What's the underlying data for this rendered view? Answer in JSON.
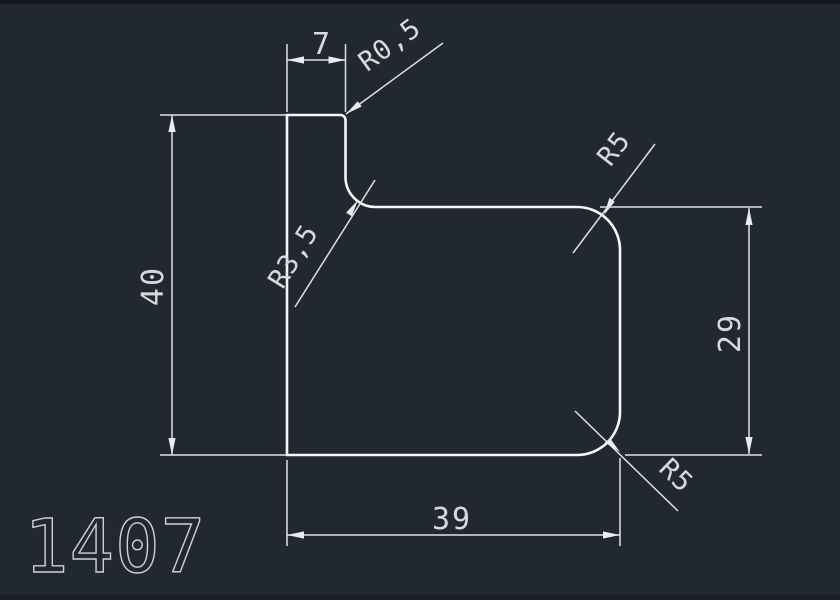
{
  "canvas": {
    "background_color": "#222830",
    "edge_strip_color": "#141920",
    "outline_color": "#f4f6f8",
    "dimension_color": "#dde2e6",
    "text_color": "#d6dadd"
  },
  "part": {
    "number": "1407"
  },
  "dimensions": {
    "width_top": {
      "label": "7"
    },
    "height_left": {
      "label": "40"
    },
    "height_right": {
      "label": "29"
    },
    "width_bottom": {
      "label": "39"
    },
    "radius_step_small": {
      "label": "R0,5"
    },
    "radius_step_large": {
      "label": "R3,5"
    },
    "radius_corner_top": {
      "label": "R5"
    },
    "radius_corner_bottom": {
      "label": "R5"
    }
  }
}
